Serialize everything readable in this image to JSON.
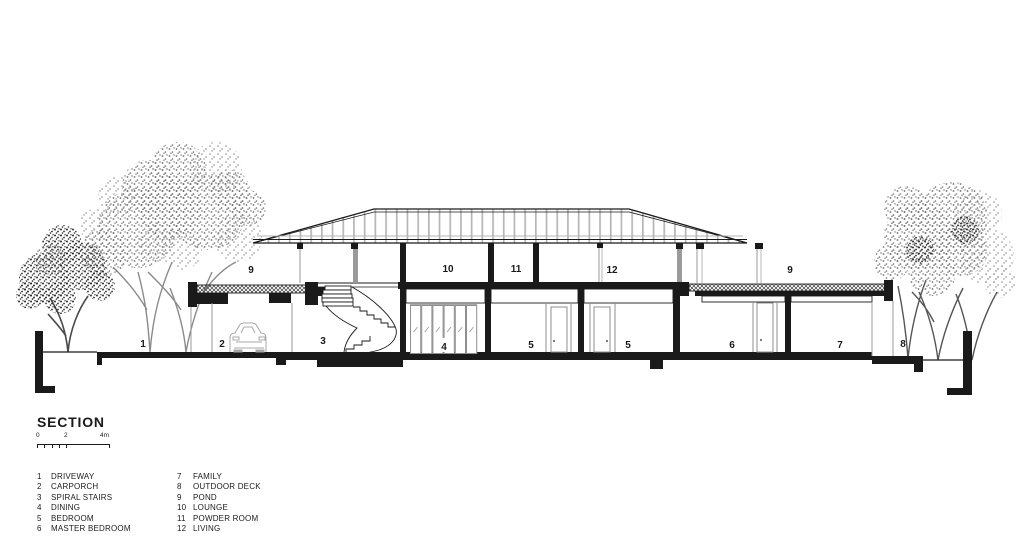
{
  "title": "SECTION",
  "scale_bar": {
    "tick0": "0",
    "tick2": "2",
    "tick4": "4m"
  },
  "rooms": {
    "n1": "1",
    "n2": "2",
    "n3": "3",
    "n4": "4",
    "n5a": "5",
    "n5b": "5",
    "n6": "6",
    "n7": "7",
    "n8": "8",
    "n9_left": "9",
    "n9_right": "9",
    "n10": "10",
    "n11": "11",
    "n12": "12"
  },
  "legend": {
    "col1": [
      {
        "num": "1",
        "label": "DRIVEWAY"
      },
      {
        "num": "2",
        "label": "CARPORCH"
      },
      {
        "num": "3",
        "label": "SPIRAL STAIRS"
      },
      {
        "num": "4",
        "label": "DINING"
      },
      {
        "num": "5",
        "label": "BEDROOM"
      },
      {
        "num": "6",
        "label": "MASTER BEDROOM"
      }
    ],
    "col2": [
      {
        "num": "7",
        "label": "FAMILY"
      },
      {
        "num": "8",
        "label": "OUTDOOR DECK"
      },
      {
        "num": "9",
        "label": "POND"
      },
      {
        "num": "10",
        "label": "LOUNGE"
      },
      {
        "num": "11",
        "label": "POWDER ROOM"
      },
      {
        "num": "12",
        "label": "LIVING"
      }
    ]
  },
  "colors": {
    "ink": "#1a1a1a",
    "line_gray": "#9a9a9a",
    "rafter_gray": "#b6b6b6",
    "tree_gray": "#7c7c7c"
  }
}
